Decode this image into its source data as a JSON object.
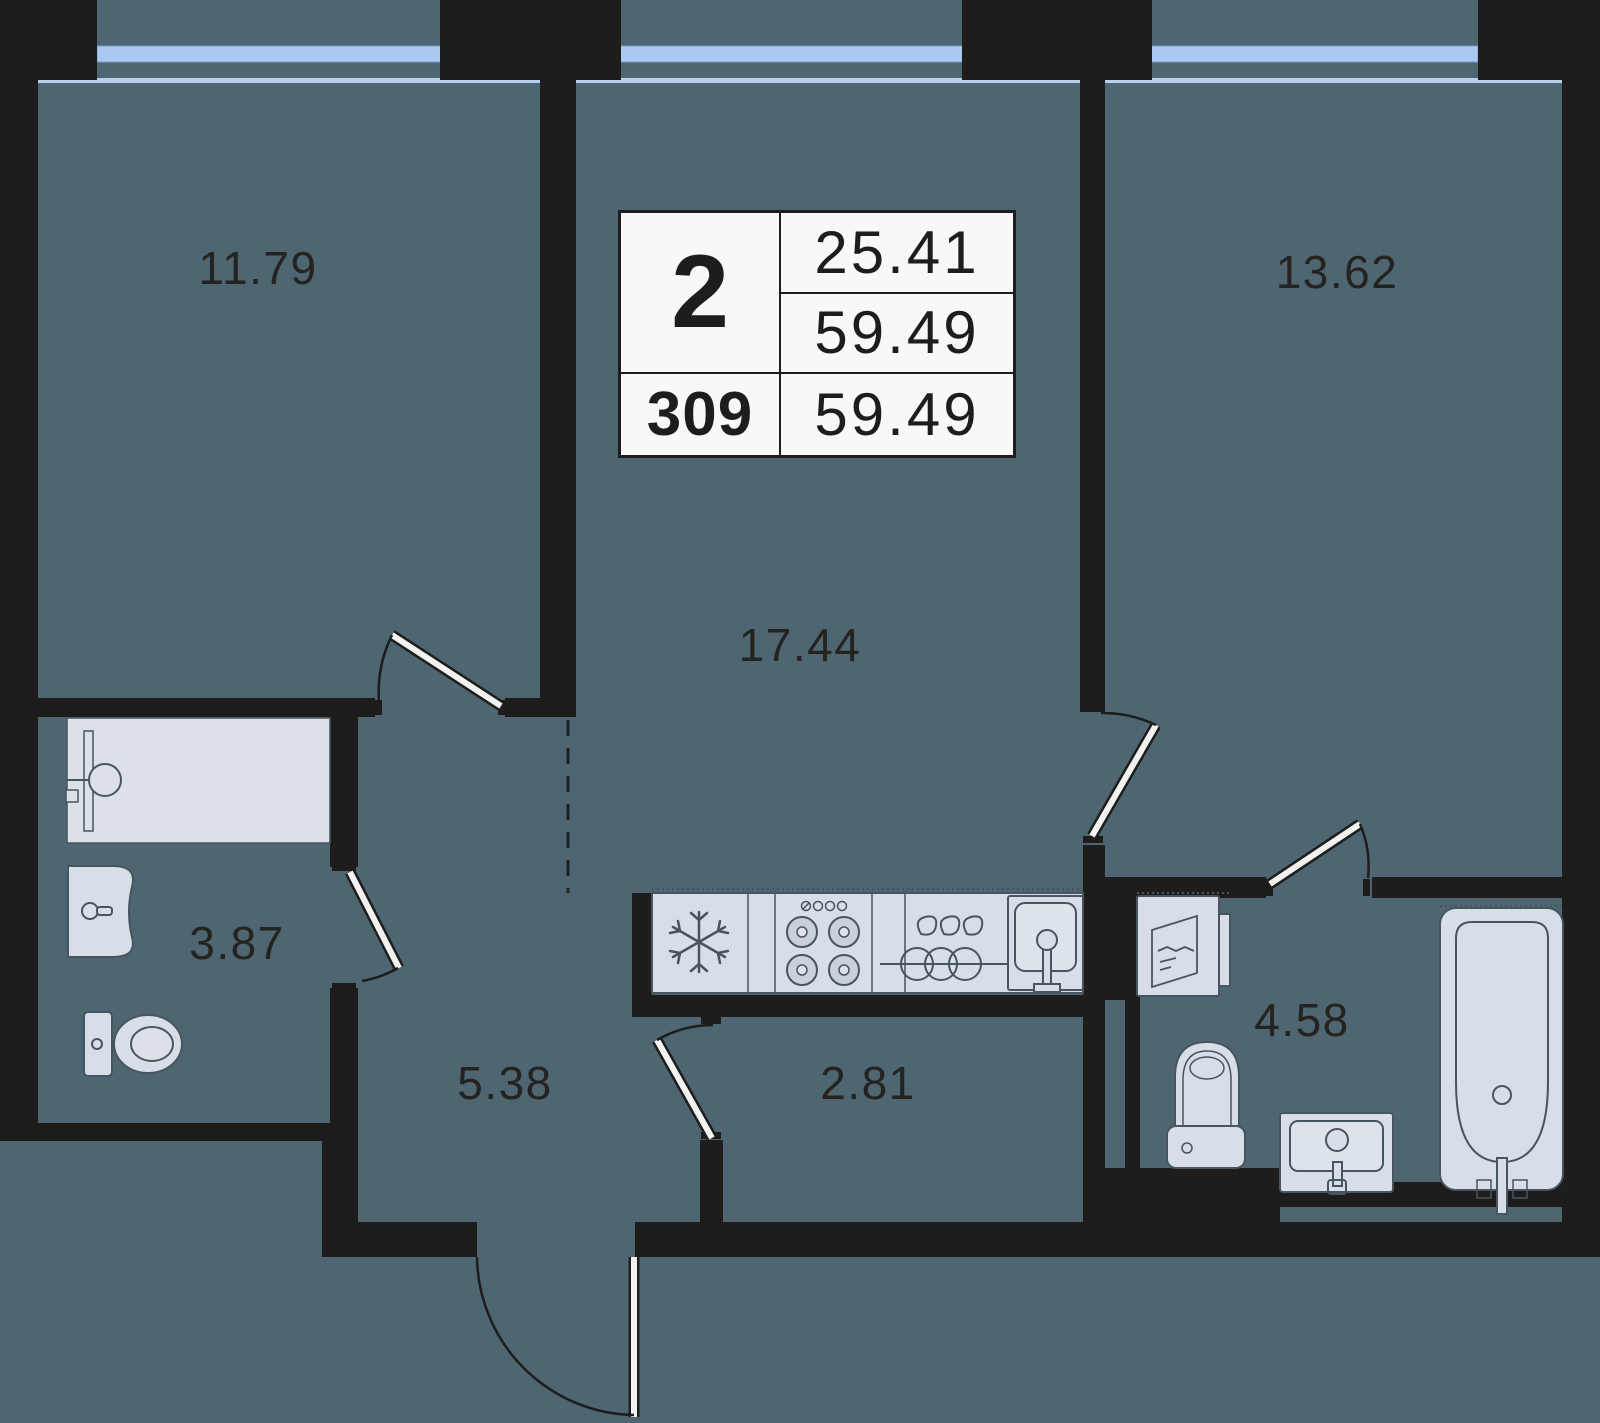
{
  "info_card": {
    "rooms_count": "2",
    "area_living": "25.41",
    "area_total": "59.49",
    "unit_number": "309",
    "area_total_repeat": "59.49"
  },
  "rooms": [
    {
      "name": "bedroom-1",
      "area": "11.79"
    },
    {
      "name": "bedroom-2",
      "area": "13.62"
    },
    {
      "name": "kitchen-living-room",
      "area": "17.44"
    },
    {
      "name": "bathroom-1",
      "area": "3.87"
    },
    {
      "name": "hallway",
      "area": "5.38"
    },
    {
      "name": "corridor",
      "area": "2.81"
    },
    {
      "name": "bathroom-2",
      "area": "4.58"
    }
  ],
  "fixtures": [
    "shower",
    "vanity-sink",
    "toilet",
    "fridge",
    "stove",
    "dish-rack",
    "kitchen-sink",
    "washing-machine",
    "toilet-2",
    "vanity-sink-2",
    "bathtub"
  ],
  "colors": {
    "floor": "#4d6671",
    "wall": "#1e1d1b",
    "window_glass": "#a9c9f1",
    "window_sill": "#b8cfe9",
    "fixture_fill": "#d7dee7",
    "fixture_stroke": "#46555f",
    "card_background": "#f8f8f6"
  }
}
